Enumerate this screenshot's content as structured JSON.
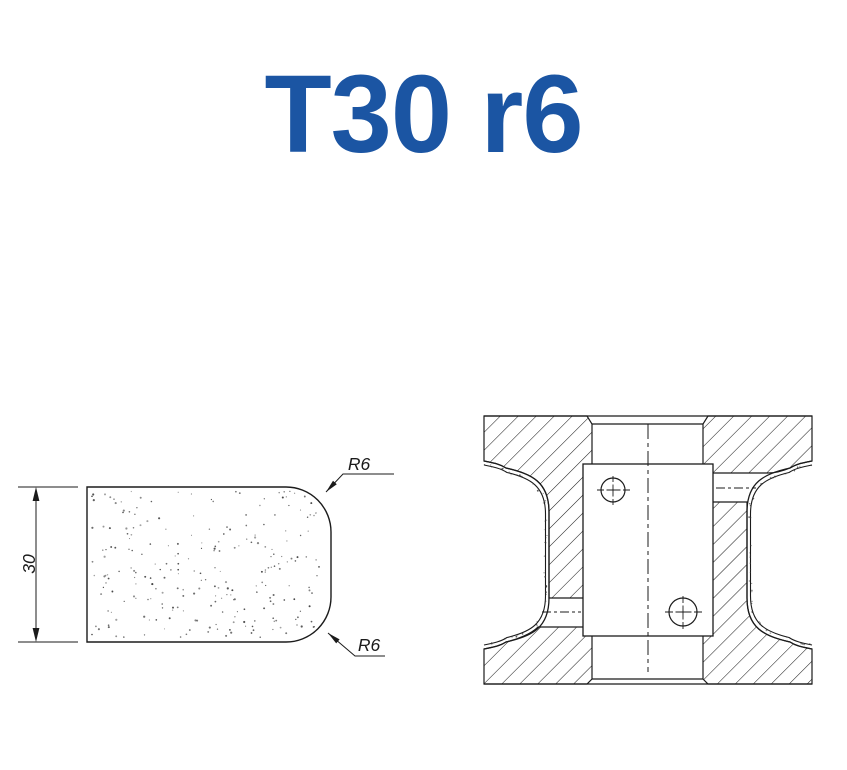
{
  "title": "T30 r6",
  "colors": {
    "title_blue": "#1B55A3",
    "line_dark": "#1b1b1b"
  },
  "profile_view": {
    "dimension_label": "30",
    "radius_top_label": "R6",
    "radius_bottom_label": "R6"
  }
}
